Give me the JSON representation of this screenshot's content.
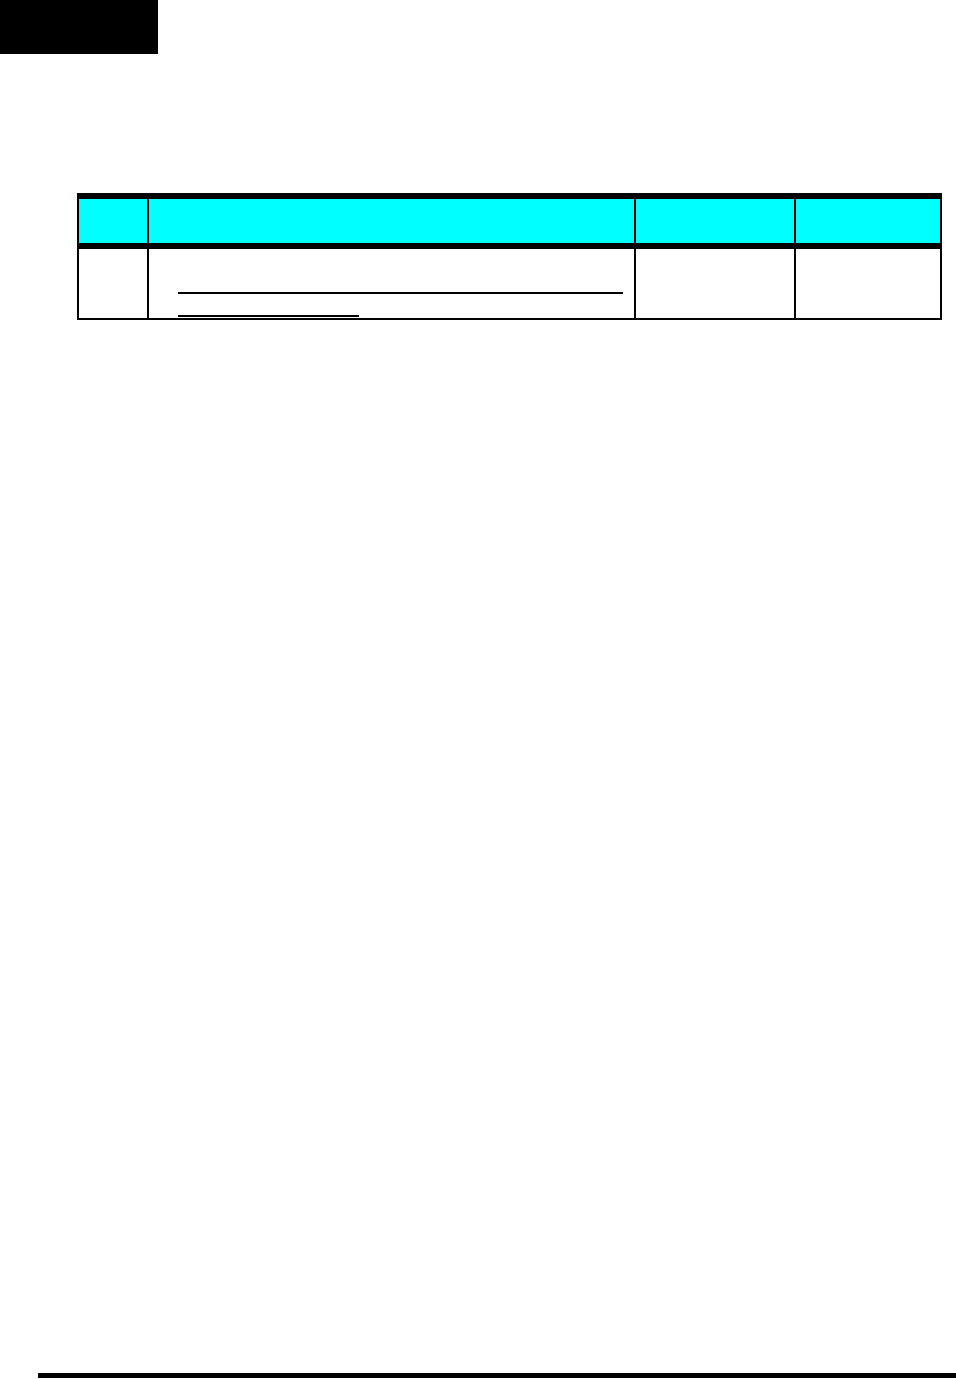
{
  "page": {
    "background": "#ffffff"
  },
  "header_block": {
    "color": "#000000"
  },
  "table": {
    "header_fill": "#00ffff",
    "border_color": "#000000",
    "columns": [
      {
        "label": ""
      },
      {
        "label": ""
      },
      {
        "label": ""
      },
      {
        "label": ""
      }
    ],
    "row": {
      "cells": [
        {
          "text": ""
        },
        {
          "text": ""
        },
        {
          "text": ""
        },
        {
          "text": ""
        }
      ],
      "blank_lines": [
        {
          "text": ""
        },
        {
          "text": ""
        }
      ]
    }
  },
  "footer_rule": {
    "color": "#000000"
  }
}
